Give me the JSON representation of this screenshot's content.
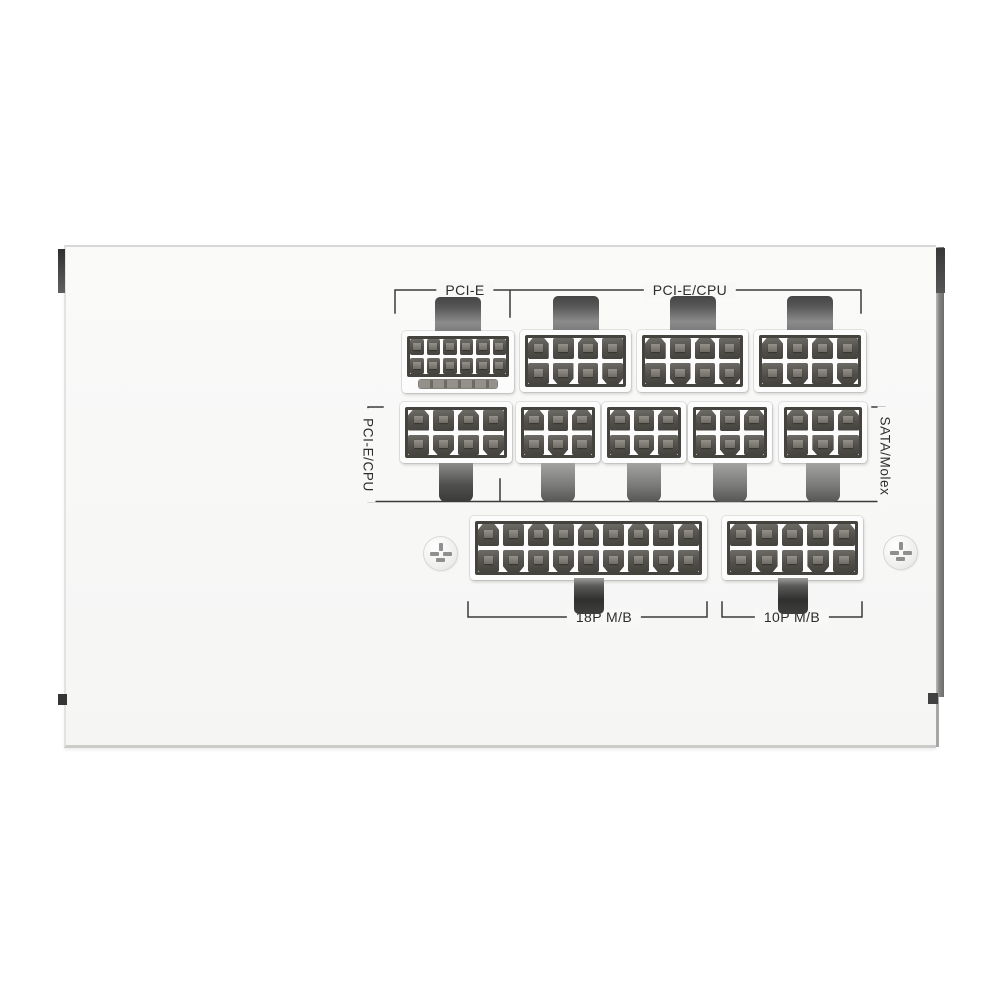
{
  "image": {
    "subject": "White modular PSU cable-connector side panel with labeled socket groups"
  },
  "labels": {
    "pcie": "PCI-E",
    "pcie_cpu_top": "PCI-E/CPU",
    "pcie_cpu_side": "PCI-E/CPU",
    "sata_molex": "SATA/Molex",
    "mb_18p": "18P M/B",
    "mb_10p": "10P M/B"
  },
  "colors": {
    "background": "#ffffff",
    "panel": "#f8f8f7",
    "bracket_line": "#3a3a3a",
    "label_text": "#2d2d2d",
    "connector_body": "#fcfcfc",
    "pin_dark": "#44423d",
    "edge_strip": "#6d6d6c"
  },
  "connectors": [
    {
      "id": "t0",
      "group": "PCI-E",
      "pins": 12,
      "rows": 2,
      "cols": 6,
      "pin_style": "small",
      "sense_slot": true,
      "tab": "top"
    },
    {
      "id": "t1",
      "group": "PCI-E/CPU",
      "pins": 8,
      "rows": 2,
      "cols": 4,
      "pin_style": "large",
      "sense_slot": false,
      "tab": "top"
    },
    {
      "id": "t2",
      "group": "PCI-E/CPU",
      "pins": 8,
      "rows": 2,
      "cols": 4,
      "pin_style": "large",
      "sense_slot": false,
      "tab": "top"
    },
    {
      "id": "t3",
      "group": "PCI-E/CPU",
      "pins": 8,
      "rows": 2,
      "cols": 4,
      "pin_style": "large",
      "sense_slot": false,
      "tab": "top"
    },
    {
      "id": "m0",
      "group": "PCI-E/CPU",
      "pins": 8,
      "rows": 2,
      "cols": 4,
      "pin_style": "large",
      "sense_slot": false,
      "tab": "bottom-dark"
    },
    {
      "id": "m1",
      "group": "SATA/Molex",
      "pins": 6,
      "rows": 2,
      "cols": 3,
      "pin_style": "large",
      "sense_slot": false,
      "tab": "bottom"
    },
    {
      "id": "m2",
      "group": "SATA/Molex",
      "pins": 6,
      "rows": 2,
      "cols": 3,
      "pin_style": "large",
      "sense_slot": false,
      "tab": "bottom"
    },
    {
      "id": "m3",
      "group": "SATA/Molex",
      "pins": 6,
      "rows": 2,
      "cols": 3,
      "pin_style": "large",
      "sense_slot": false,
      "tab": "bottom"
    },
    {
      "id": "m4",
      "group": "SATA/Molex",
      "pins": 6,
      "rows": 2,
      "cols": 3,
      "pin_style": "large",
      "sense_slot": false,
      "tab": "bottom"
    },
    {
      "id": "b0",
      "group": "18P M/B",
      "pins": 18,
      "rows": 2,
      "cols": 9,
      "pin_style": "large",
      "sense_slot": false,
      "tab": "bottom-clip"
    },
    {
      "id": "b1",
      "group": "10P M/B",
      "pins": 10,
      "rows": 2,
      "cols": 5,
      "pin_style": "large",
      "sense_slot": false,
      "tab": "bottom-clip"
    }
  ],
  "screws": [
    {
      "id": "left",
      "type": "phillips-screw"
    },
    {
      "id": "right",
      "type": "phillips-screw"
    }
  ]
}
